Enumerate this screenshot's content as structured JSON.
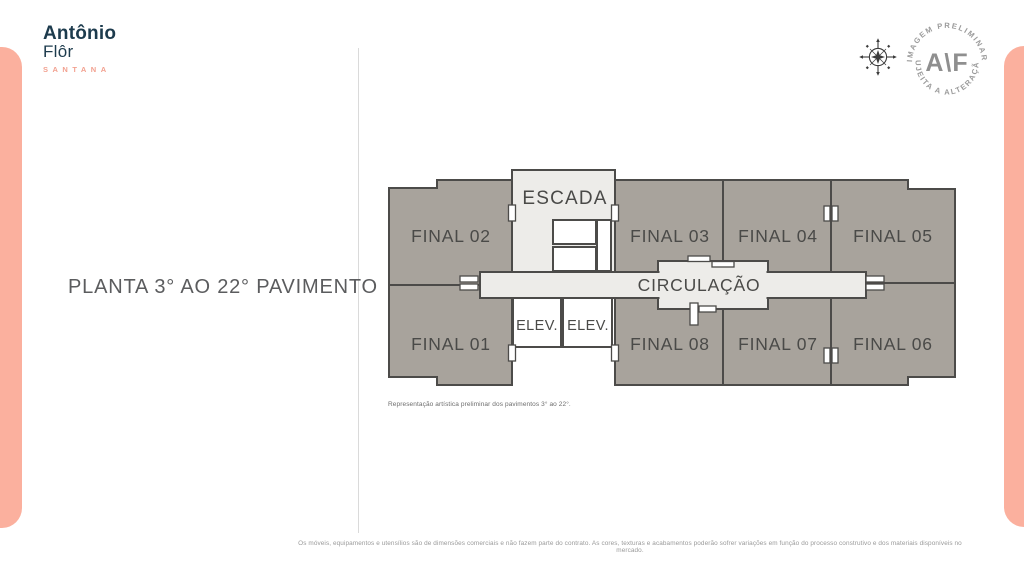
{
  "brand": {
    "line1": "Antônio",
    "line2": "Flôr",
    "tagline": "SANTANA"
  },
  "page_title": "PLANTA 3° AO 22° PAVIMENTO",
  "plan": {
    "units": [
      {
        "label": "FINAL 02"
      },
      {
        "label": "FINAL 03"
      },
      {
        "label": "FINAL 04"
      },
      {
        "label": "FINAL 05"
      },
      {
        "label": "FINAL 01"
      },
      {
        "label": "FINAL 08"
      },
      {
        "label": "FINAL 07"
      },
      {
        "label": "FINAL 06"
      }
    ],
    "rooms": {
      "escada": "ESCADA",
      "circulacao": "CIRCULAÇÃO",
      "elev1": "ELEV.",
      "elev2": "ELEV."
    },
    "caption": "Representação artística preliminar dos pavimentos 3° ao 22°."
  },
  "stamp": {
    "arc_top": "| IMAGEM PRELIMINAR |",
    "arc_bottom": "SUJEITA A ALTERAÇÃO",
    "monogram": "A\\F"
  },
  "footer": {
    "disclaimer": "Os móveis, equipamentos e utensílios são de dimensões comerciais e não fazem parte do contrato. As cores, texturas e acabamentos poderão sofrer variações em função do processo construtivo e dos materiais disponíveis no mercado."
  },
  "colors": {
    "accent_salmon": "#fbb09e",
    "brand_navy": "#1d3b4d",
    "tagline_salmon": "#f2a08f",
    "unit_fill": "#a8a39c",
    "light_fill": "#edece9",
    "wall": "#4c4b49",
    "title_gray": "#5b5c5e"
  }
}
